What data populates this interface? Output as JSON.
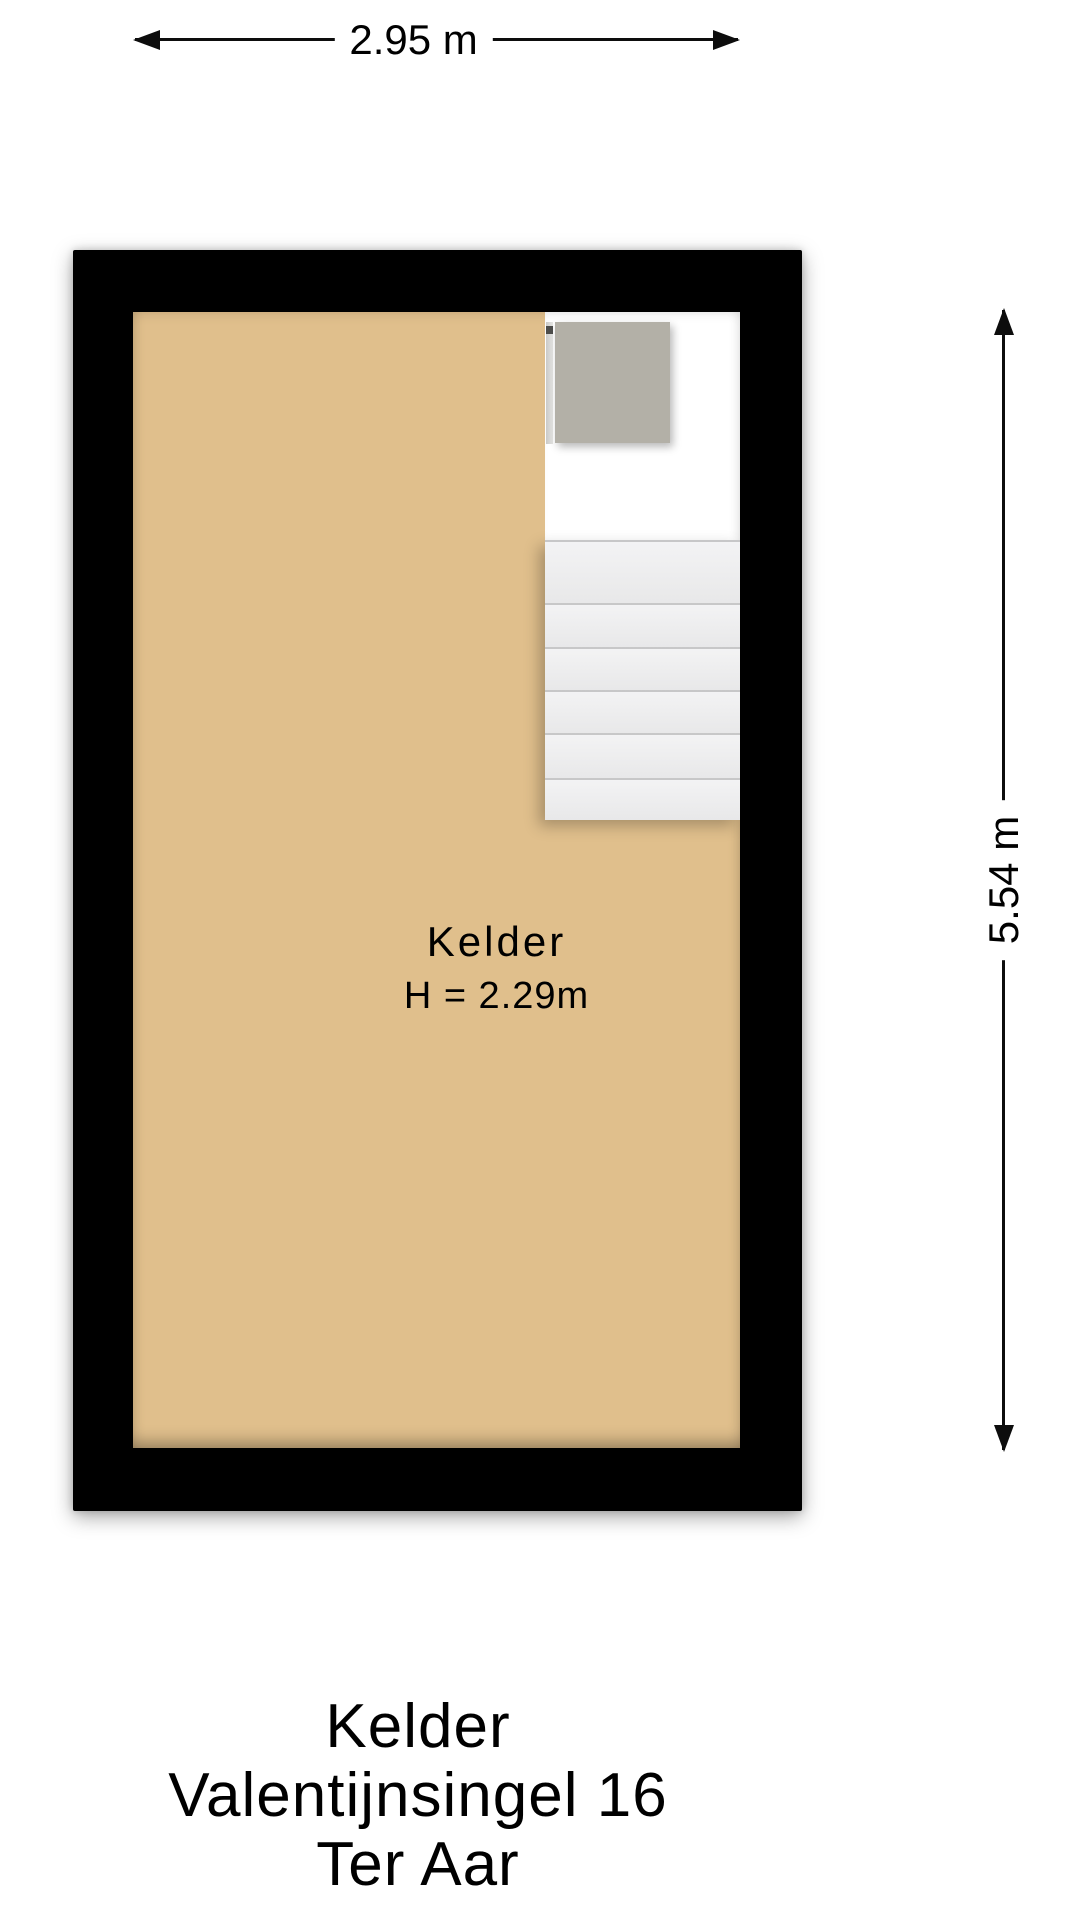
{
  "dimensions": {
    "width_label": "2.95 m",
    "height_label": "5.54 m"
  },
  "room": {
    "name": "Kelder",
    "height_text": "H = 2.29m"
  },
  "caption": {
    "line1": "Kelder",
    "line2": "Valentijnsingel 16",
    "line3": "Ter Aar"
  },
  "floorplan": {
    "stairs": {
      "tread_count": 6
    },
    "colors": {
      "wall": "#000000",
      "floor": "#e0bf8c",
      "landing": "#b3b0a7",
      "tread": "#efeff0",
      "dimension_line": "#0d0d0d",
      "background": "#ffffff"
    }
  }
}
